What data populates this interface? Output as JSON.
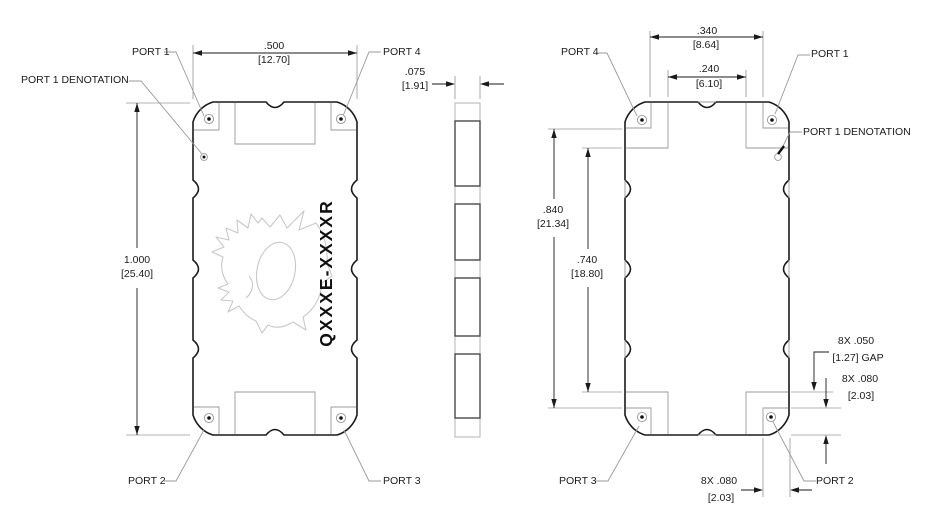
{
  "drawing": {
    "part_number": "QXXXE-XXXXR",
    "logo": "dragon-logo",
    "colors": {
      "outline": "#1a1a1a",
      "thin_line": "#9a9a9a",
      "logo_line": "#c8c8c8"
    },
    "top_view": {
      "port1": "PORT 1",
      "port2": "PORT 2",
      "port3": "PORT 3",
      "port4": "PORT 4",
      "port1_denotation": "PORT 1 DENOTATION",
      "dim_width_in": ".500",
      "dim_width_mm": "[12.70]",
      "dim_height_in": "1.000",
      "dim_height_mm": "[25.40]"
    },
    "side_view": {
      "dim_thickness_in": ".075",
      "dim_thickness_mm": "[1.91]"
    },
    "bottom_view": {
      "port1": "PORT 1",
      "port2": "PORT 2",
      "port3": "PORT 3",
      "port4": "PORT 4",
      "port1_denotation": "PORT 1 DENOTATION",
      "dim_pad_span_in": ".340",
      "dim_pad_span_mm": "[8.64]",
      "dim_inner_span_in": ".240",
      "dim_inner_span_mm": "[6.10]",
      "dim_outer_height_in": ".840",
      "dim_outer_height_mm": "[21.34]",
      "dim_inner_height_in": ".740",
      "dim_inner_height_mm": "[18.80]",
      "dim_gap_qty": "8X .050",
      "dim_gap_mm": "[1.27] GAP",
      "dim_pad_height_qty": "8X .080",
      "dim_pad_height_mm": "[2.03]",
      "dim_pad_width_qty": "8X .080",
      "dim_pad_width_mm": "[2.03]"
    }
  }
}
